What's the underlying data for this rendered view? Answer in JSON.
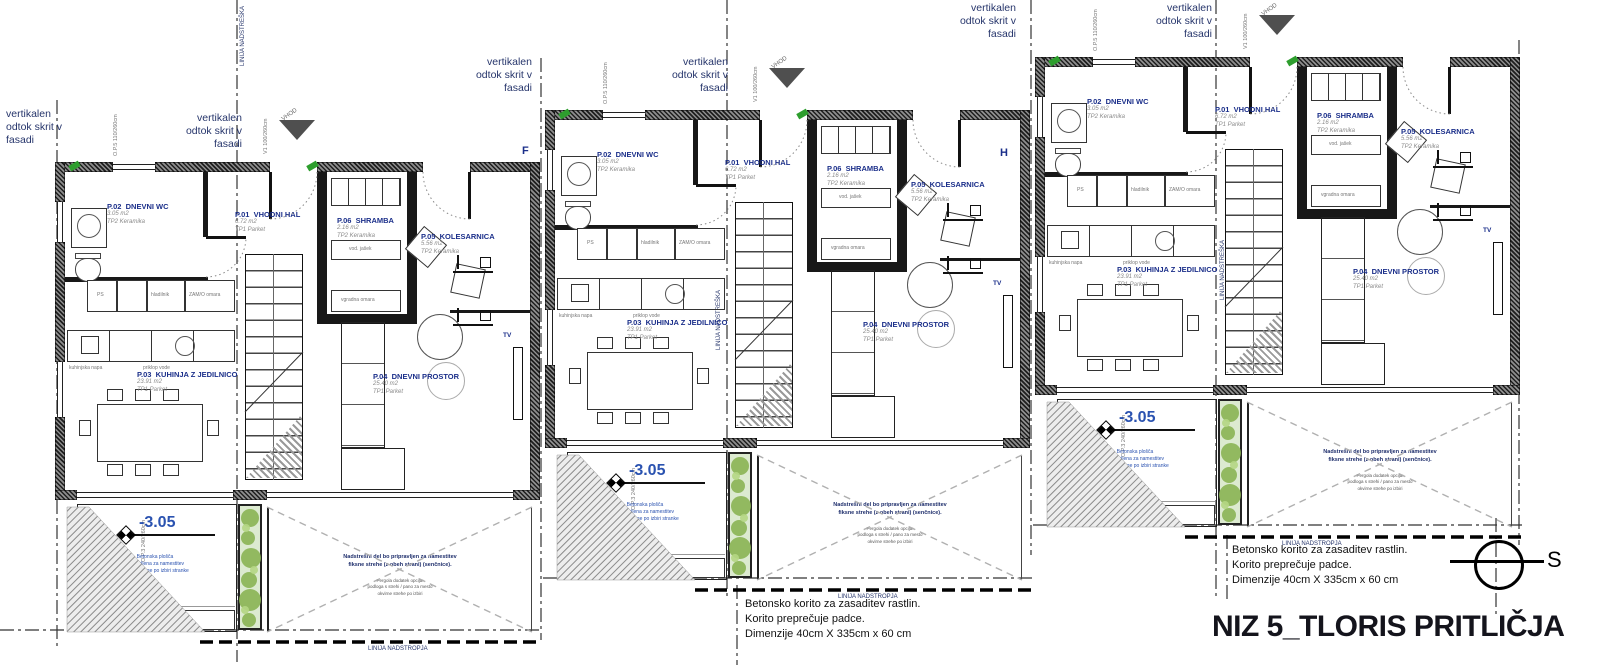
{
  "title": "NIZ 5_TLORIS PRITLIČJA",
  "north": {
    "label": "S"
  },
  "notes": {
    "drain": "vertikalen\nodtok skrit v\nfasadi",
    "planter": "Betonsko korito za zasaditev rastlin.\nKorito preprečuje padce.\nDimenzije 40cm X 335cm x 60 cm",
    "canopy_line": "LINIJA NADSTREŠKA",
    "storey_line": "LINIJA NADSTROPJA",
    "pergola_main": "Nadstrešni del bo pripravljen za namestitev\nfiksne strehe (z obeh strani) (senčnice).",
    "pergola_sub": "Pergola dodatek opcija:\npodloga s strehi / pano za mesto\nokvirne strehe po izbiri",
    "terrace_sub": "Betonska plošča\npripravljena za namestitev\nfinalne obloge po izbiri stranke"
  },
  "grid": {
    "f": "F",
    "h": "H"
  },
  "tags": {
    "window_top": "O.P.5  110/260cm",
    "door_entry": "V1  100/260cm",
    "door_terrace": "O.P.3  240/260cm",
    "vhod": "VHOD"
  },
  "appliances": {
    "ps": "PS",
    "fridge": "hladilnik",
    "cab": "ZAM/O omara",
    "shaft": "vod. jašek",
    "wardrobe": "vgradna omara",
    "hood": "kuhinjska napa",
    "water": "priklop vode"
  },
  "units": [
    {
      "elevation": "-3.05",
      "section": "",
      "tv": "TV",
      "rooms": {
        "hall": {
          "code": "P.01",
          "name": "VHODNI HAL",
          "area": "6.72 m2",
          "finish": "TP1 Parket"
        },
        "wc": {
          "code": "P.02",
          "name": "DNEVNI WC",
          "area": "3.05 m2",
          "finish": "TP2 Keramika"
        },
        "kitchen": {
          "code": "P.03",
          "name": "KUHINJA Z JEDILNICO",
          "area": "23.91 m2",
          "finish": "TP1 Parket"
        },
        "living": {
          "code": "P.04",
          "name": "DNEVNI PROSTOR",
          "area": "25.40 m2",
          "finish": "TP1 Parket"
        },
        "bike": {
          "code": "P.05",
          "name": "KOLESARNICA",
          "area": "5.56 m2",
          "finish": "TP2 Keramika"
        },
        "storage": {
          "code": "P.06",
          "name": "SHRAMBA",
          "area": "2.16 m2",
          "finish": "TP2 Keramika"
        }
      }
    },
    {
      "elevation": "-3.05",
      "section": "D,d",
      "tv": "TV",
      "rooms": {
        "hall": {
          "code": "P.01",
          "name": "VHODNI HAL",
          "area": "6.72 m2",
          "finish": "TP1 Parket"
        },
        "wc": {
          "code": "P.02",
          "name": "DNEVNI WC",
          "area": "3.05 m2",
          "finish": "TP2 Keramika"
        },
        "kitchen": {
          "code": "P.03",
          "name": "KUHINJA Z JEDILNICO",
          "area": "23.91 m2",
          "finish": "TP1 Parket"
        },
        "living": {
          "code": "P.04",
          "name": "DNEVNI PROSTOR",
          "area": "25.40 m2",
          "finish": "TP1 Parket"
        },
        "bike": {
          "code": "P.05",
          "name": "KOLESARNICA",
          "area": "5.56 m2",
          "finish": "TP2 Keramika"
        },
        "storage": {
          "code": "P.06",
          "name": "SHRAMBA",
          "area": "2.16 m2",
          "finish": "TP2 Keramika"
        }
      }
    },
    {
      "elevation": "-3.05",
      "section": "G,g",
      "tv": "TV",
      "rooms": {
        "hall": {
          "code": "P.01",
          "name": "VHODNI HAL",
          "area": "6.72 m2",
          "finish": "TP1 Parket"
        },
        "wc": {
          "code": "P.02",
          "name": "DNEVNI WC",
          "area": "3.05 m2",
          "finish": "TP2 Keramika"
        },
        "kitchen": {
          "code": "P.03",
          "name": "KUHINJA Z JEDILNICO",
          "area": "23.91 m2",
          "finish": "TP1 Parket"
        },
        "living": {
          "code": "P.04",
          "name": "DNEVNI PROSTOR",
          "area": "25.40 m2",
          "finish": "TP1 Parket"
        },
        "bike": {
          "code": "P.05",
          "name": "KOLESARNICA",
          "area": "5.56 m2",
          "finish": "TP2 Keramika"
        },
        "storage": {
          "code": "P.06",
          "name": "SHRAMBA",
          "area": "2.16 m2",
          "finish": "TP2 Keramika"
        }
      }
    }
  ]
}
